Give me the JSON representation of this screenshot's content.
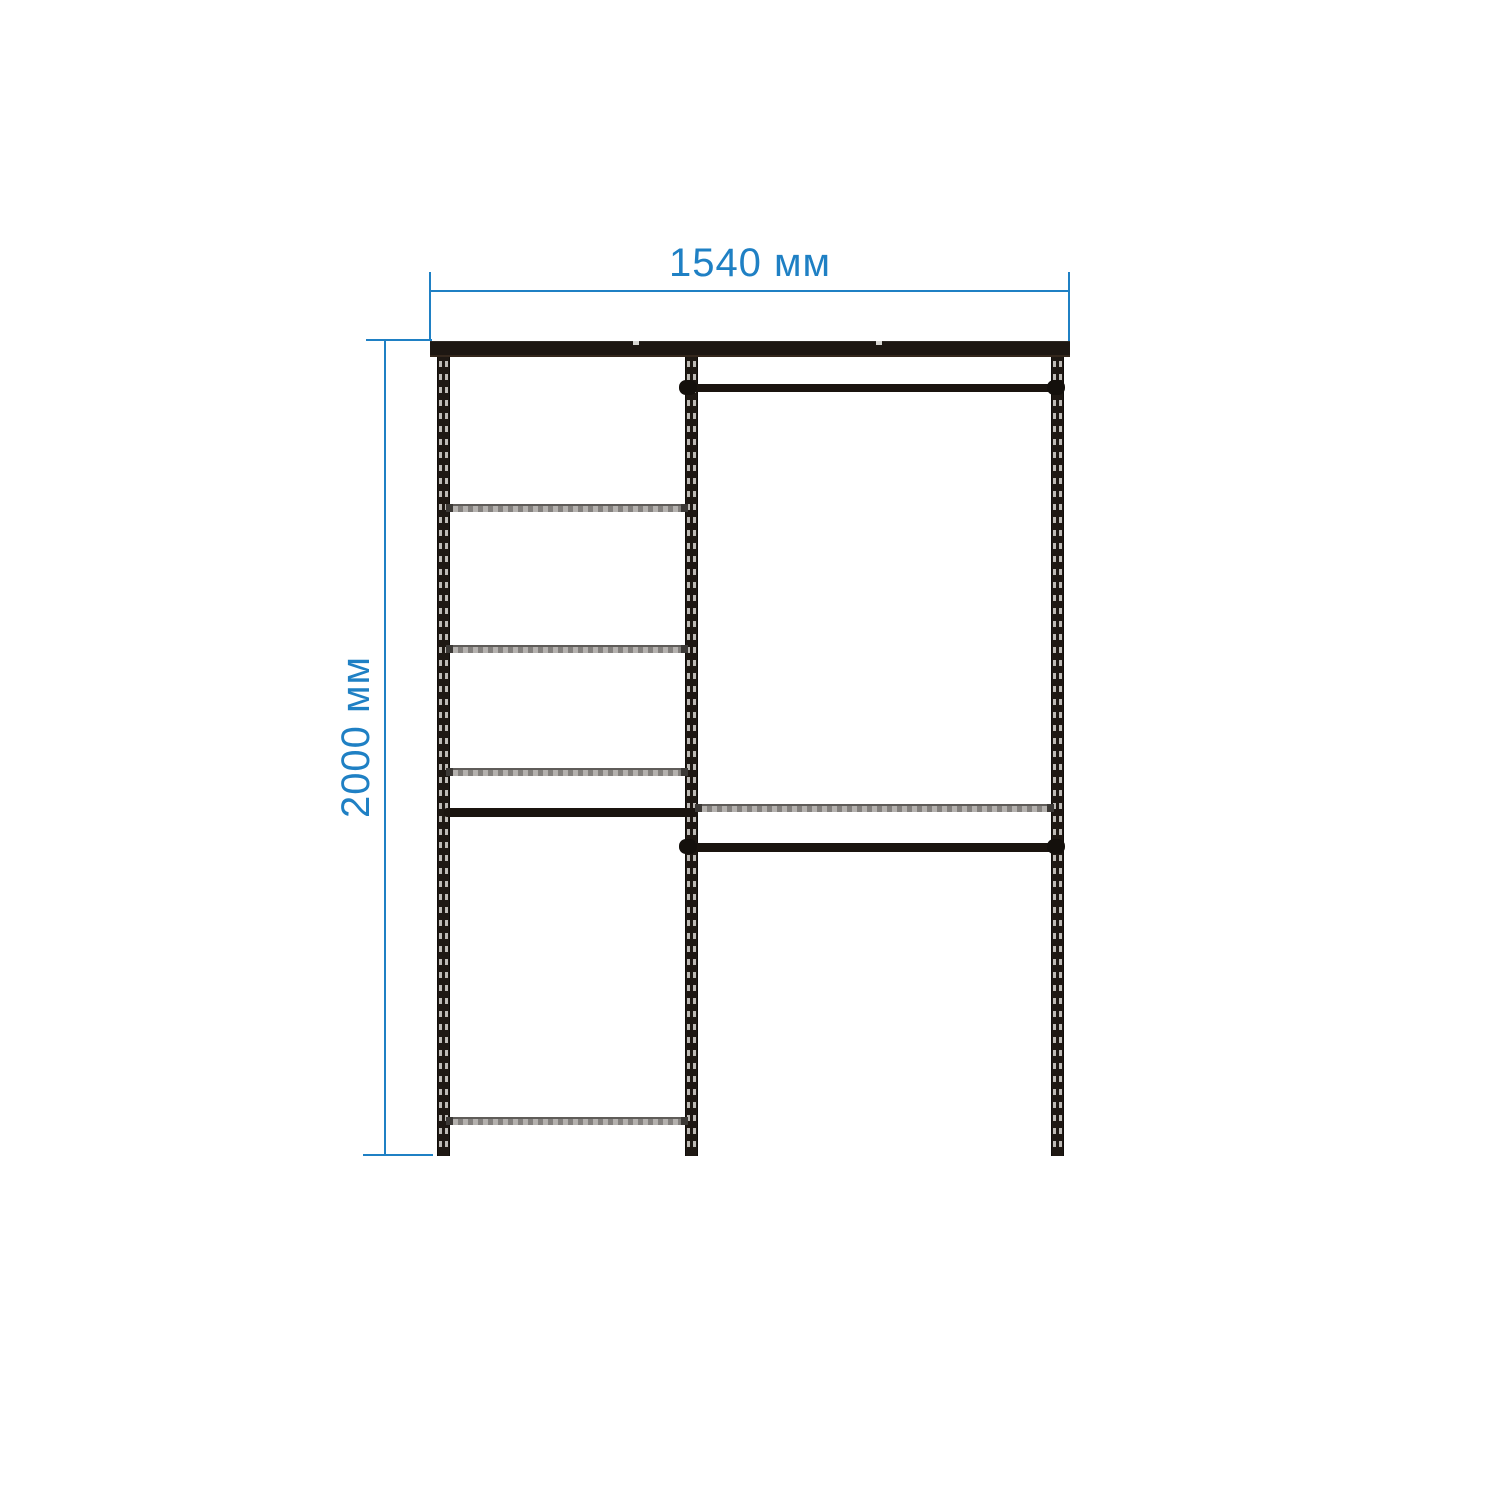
{
  "diagram": {
    "type": "wardrobe-shelving-dimension-drawing",
    "dimensions": {
      "width": {
        "label": "1540 мм"
      },
      "height": {
        "label": "2000 мм"
      }
    },
    "structure": {
      "uprights": 3,
      "left_bay": {
        "shelves": 4,
        "hang_bars": 1
      },
      "right_bay": {
        "shelves": 1,
        "hang_rods": 2
      }
    }
  },
  "colors": {
    "dimension_blue": "#1f80c4",
    "frame_dark": "#1e1813",
    "shelf_gray": "#84817e",
    "slot_light": "#d9d6d2",
    "background": "#ffffff"
  }
}
